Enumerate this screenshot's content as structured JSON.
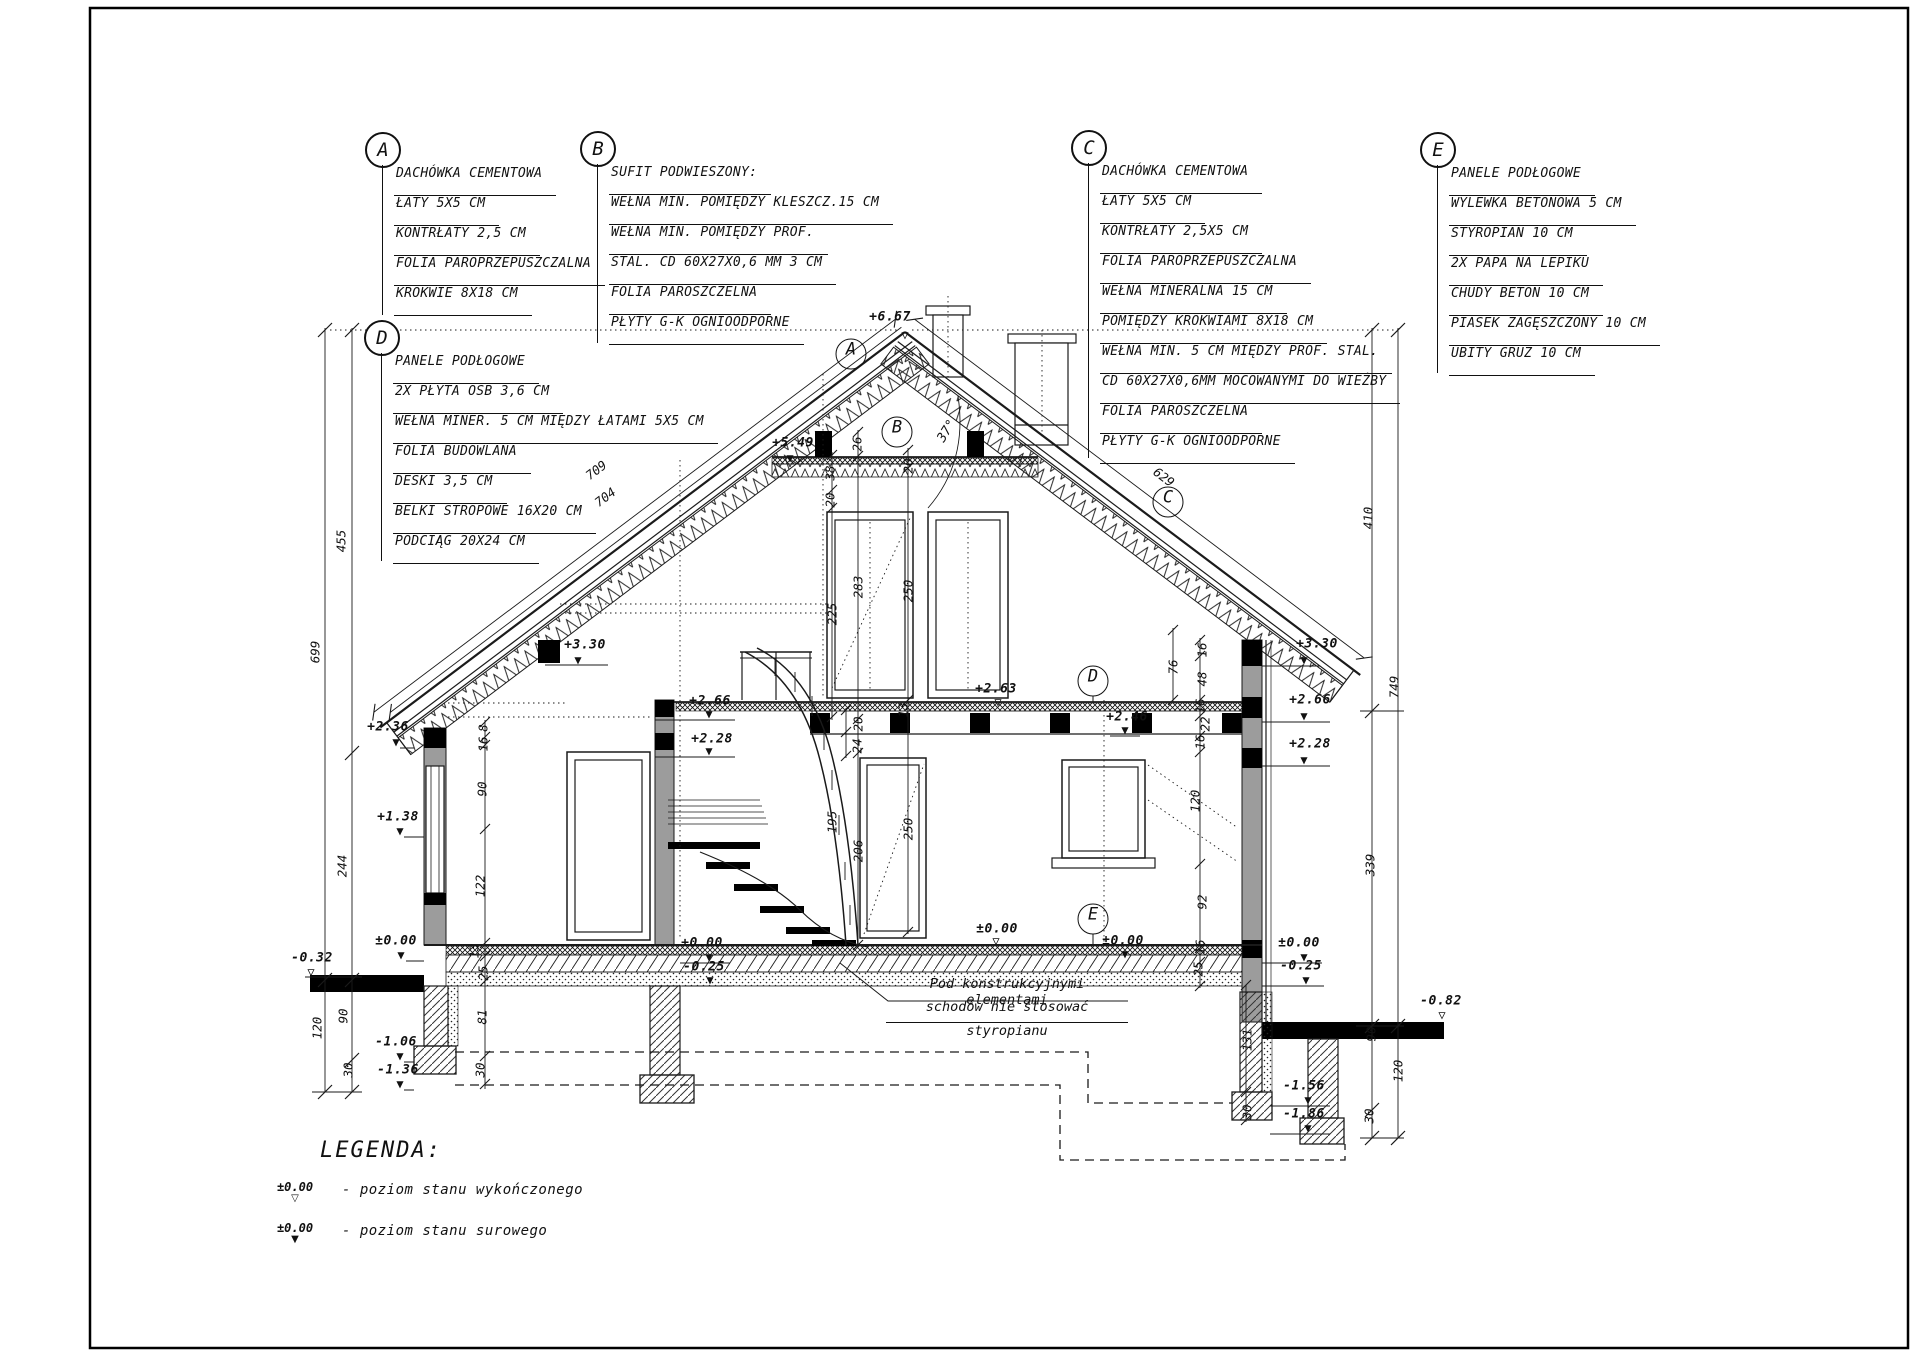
{
  "callouts": {
    "a": {
      "letter": "A",
      "items": [
        "DACHÓWKA CEMENTOWA",
        "ŁATY 5X5 CM",
        "KONTRŁATY 2,5 CM",
        "FOLIA PAROPRZEPUSZCZALNA",
        "KROKWIE 8X18 CM"
      ]
    },
    "b": {
      "letter": "B",
      "items": [
        "SUFIT PODWIESZONY:",
        "WEŁNA MIN. POMIĘDZY KLESZCZ.15 CM",
        "WEŁNA MIN. POMIĘDZY PROF.",
        "STAL. CD 60X27X0,6 MM 3 CM",
        "FOLIA PAROSZCZELNA",
        "PŁYTY G-K OGNIOODPORNE"
      ]
    },
    "c": {
      "letter": "C",
      "items": [
        "DACHÓWKA CEMENTOWA",
        "ŁATY 5X5 CM",
        "KONTRŁATY 2,5X5 CM",
        "FOLIA PAROPRZEPUSZCZALNA",
        "WEŁNA MINERALNA 15 CM",
        "POMIĘDZY KROKWIAMI 8X18 CM",
        "WEŁNA MIN. 5 CM MIĘDZY PROF. STAL.",
        "CD 60X27X0,6MM MOCOWANYMI DO WIEŻBY",
        "FOLIA PAROSZCZELNA",
        "PŁYTY G-K OGNIOODPORNE"
      ]
    },
    "d": {
      "letter": "D",
      "items": [
        "PANELE PODŁOGOWE",
        "2X PŁYTA OSB 3,6 CM",
        "WEŁNA MINER. 5 CM MIĘDZY ŁATAMI 5X5 CM",
        "FOLIA BUDOWLANA",
        "DESKI 3,5 CM",
        "BELKI STROPOWE 16X20 CM",
        "PODCIĄG 20X24 CM"
      ]
    },
    "e": {
      "letter": "E",
      "items": [
        "PANELE PODŁOGOWE",
        "WYLEWKA BETONOWA 5 CM",
        "STYROPIAN 10 CM",
        "2X PAPA NA LEPIKU",
        "CHUDY BETON 10 CM",
        "PIASEK ZAGĘSZCZONY 10 CM",
        "UBITY GRUZ 10 CM"
      ]
    }
  },
  "legend": {
    "title": "LEGENDA:",
    "items": [
      {
        "level": "±0.00",
        "symbol": "▽",
        "label": "- poziom stanu wykończonego"
      },
      {
        "level": "±0.00",
        "symbol": "▼",
        "label": "- poziom stanu surowego"
      }
    ]
  },
  "note": {
    "lines": [
      "Pod konstrukcyjnymi elementami",
      "schodów nie stosować",
      "styropianu"
    ]
  },
  "annotations": [
    {
      "t": "+6.67",
      "x": 890,
      "y": 317,
      "r": 0,
      "c": "elev"
    },
    {
      "t": "▽",
      "x": 905,
      "y": 335,
      "r": 0,
      "c": "symo"
    },
    {
      "t": "+5.49",
      "x": 793,
      "y": 443,
      "r": 0,
      "c": "elev"
    },
    {
      "t": "▼",
      "x": 790,
      "y": 458,
      "r": 0,
      "c": "symf"
    },
    {
      "t": "37°",
      "x": 947,
      "y": 431,
      "r": -58,
      "c": "deg"
    },
    {
      "t": "+3.30",
      "x": 585,
      "y": 645,
      "r": 0,
      "c": "elev"
    },
    {
      "t": "▼",
      "x": 578,
      "y": 660,
      "r": 0,
      "c": "symf"
    },
    {
      "t": "+3.30",
      "x": 1317,
      "y": 644,
      "r": 0,
      "c": "elev"
    },
    {
      "t": "▼",
      "x": 1304,
      "y": 660,
      "r": 0,
      "c": "symf"
    },
    {
      "t": "+2.36",
      "x": 388,
      "y": 727,
      "r": 0,
      "c": "elev"
    },
    {
      "t": "▼",
      "x": 396,
      "y": 742,
      "r": 0,
      "c": "symf"
    },
    {
      "t": "+2.66",
      "x": 710,
      "y": 701,
      "r": 0,
      "c": "elev"
    },
    {
      "t": "▼",
      "x": 709,
      "y": 714,
      "r": 0,
      "c": "symf"
    },
    {
      "t": "+2.28",
      "x": 712,
      "y": 739,
      "r": 0,
      "c": "elev"
    },
    {
      "t": "▼",
      "x": 709,
      "y": 751,
      "r": 0,
      "c": "symf"
    },
    {
      "t": "+2.63",
      "x": 996,
      "y": 689,
      "r": 0,
      "c": "elev"
    },
    {
      "t": "▽",
      "x": 998,
      "y": 702,
      "r": 0,
      "c": "symo"
    },
    {
      "t": "+2.46",
      "x": 1127,
      "y": 717,
      "r": 0,
      "c": "elev"
    },
    {
      "t": "▼",
      "x": 1125,
      "y": 730,
      "r": 0,
      "c": "symf"
    },
    {
      "t": "+2.66",
      "x": 1310,
      "y": 700,
      "r": 0,
      "c": "elev"
    },
    {
      "t": "▼",
      "x": 1304,
      "y": 716,
      "r": 0,
      "c": "symf"
    },
    {
      "t": "+2.28",
      "x": 1310,
      "y": 744,
      "r": 0,
      "c": "elev"
    },
    {
      "t": "▼",
      "x": 1304,
      "y": 760,
      "r": 0,
      "c": "symf"
    },
    {
      "t": "+1.38",
      "x": 398,
      "y": 817,
      "r": 0,
      "c": "elev"
    },
    {
      "t": "▼",
      "x": 400,
      "y": 831,
      "r": 0,
      "c": "symf"
    },
    {
      "t": "±0.00",
      "x": 396,
      "y": 941,
      "r": 0,
      "c": "elev"
    },
    {
      "t": "▼",
      "x": 401,
      "y": 955,
      "r": 0,
      "c": "symf"
    },
    {
      "t": "-0.32",
      "x": 312,
      "y": 958,
      "r": 0,
      "c": "elev"
    },
    {
      "t": "▽",
      "x": 311,
      "y": 972,
      "r": 0,
      "c": "symo"
    },
    {
      "t": "+0.00",
      "x": 702,
      "y": 943,
      "r": 0,
      "c": "elev"
    },
    {
      "t": "▼",
      "x": 709,
      "y": 957,
      "r": 0,
      "c": "symf"
    },
    {
      "t": "-0.25",
      "x": 704,
      "y": 967,
      "r": 0,
      "c": "elev"
    },
    {
      "t": "▼",
      "x": 710,
      "y": 980,
      "r": 0,
      "c": "symf"
    },
    {
      "t": "±0.00",
      "x": 997,
      "y": 929,
      "r": 0,
      "c": "elev"
    },
    {
      "t": "▽",
      "x": 996,
      "y": 941,
      "r": 0,
      "c": "symo"
    },
    {
      "t": "±0.00",
      "x": 1123,
      "y": 941,
      "r": 0,
      "c": "elev"
    },
    {
      "t": "▼",
      "x": 1125,
      "y": 954,
      "r": 0,
      "c": "symf"
    },
    {
      "t": "±0.00",
      "x": 1299,
      "y": 943,
      "r": 0,
      "c": "elev"
    },
    {
      "t": "▼",
      "x": 1304,
      "y": 957,
      "r": 0,
      "c": "symf"
    },
    {
      "t": "-0.25",
      "x": 1301,
      "y": 966,
      "r": 0,
      "c": "elev"
    },
    {
      "t": "▼",
      "x": 1306,
      "y": 980,
      "r": 0,
      "c": "symf"
    },
    {
      "t": "-0.82",
      "x": 1441,
      "y": 1001,
      "r": 0,
      "c": "elev"
    },
    {
      "t": "▽",
      "x": 1442,
      "y": 1015,
      "r": 0,
      "c": "symo"
    },
    {
      "t": "-1.06",
      "x": 396,
      "y": 1042,
      "r": 0,
      "c": "elev"
    },
    {
      "t": "▼",
      "x": 400,
      "y": 1056,
      "r": 0,
      "c": "symf"
    },
    {
      "t": "-1.36",
      "x": 398,
      "y": 1070,
      "r": 0,
      "c": "elev"
    },
    {
      "t": "▼",
      "x": 400,
      "y": 1084,
      "r": 0,
      "c": "symf"
    },
    {
      "t": "-1.56",
      "x": 1304,
      "y": 1086,
      "r": 0,
      "c": "elev"
    },
    {
      "t": "▼",
      "x": 1308,
      "y": 1100,
      "r": 0,
      "c": "symf"
    },
    {
      "t": "-1.86",
      "x": 1304,
      "y": 1114,
      "r": 0,
      "c": "elev"
    },
    {
      "t": "▼",
      "x": 1308,
      "y": 1128,
      "r": 0,
      "c": "symf"
    },
    {
      "t": "699",
      "x": 315,
      "y": 652,
      "r": -90,
      "c": "dim"
    },
    {
      "t": "455",
      "x": 341,
      "y": 541,
      "r": -90,
      "c": "dim"
    },
    {
      "t": "244",
      "x": 342,
      "y": 866,
      "r": -90,
      "c": "dim"
    },
    {
      "t": "120",
      "x": 317,
      "y": 1028,
      "r": -90,
      "c": "dim"
    },
    {
      "t": "90",
      "x": 343,
      "y": 1016,
      "r": -90,
      "c": "dim"
    },
    {
      "t": "30",
      "x": 348,
      "y": 1070,
      "r": -90,
      "c": "dim"
    },
    {
      "t": "410",
      "x": 1368,
      "y": 518,
      "r": -90,
      "c": "dim"
    },
    {
      "t": "749",
      "x": 1394,
      "y": 687,
      "r": -90,
      "c": "dim"
    },
    {
      "t": "339",
      "x": 1370,
      "y": 865,
      "r": -90,
      "c": "dim"
    },
    {
      "t": "90",
      "x": 1371,
      "y": 1034,
      "r": -90,
      "c": "dim"
    },
    {
      "t": "120",
      "x": 1398,
      "y": 1071,
      "r": -90,
      "c": "dim"
    },
    {
      "t": "30",
      "x": 1369,
      "y": 1116,
      "r": -90,
      "c": "dim"
    },
    {
      "t": "8",
      "x": 483,
      "y": 728,
      "r": -90,
      "c": "dim"
    },
    {
      "t": "16",
      "x": 483,
      "y": 744,
      "r": -90,
      "c": "dim"
    },
    {
      "t": "90",
      "x": 482,
      "y": 789,
      "r": -90,
      "c": "dim"
    },
    {
      "t": "122",
      "x": 480,
      "y": 886,
      "r": -90,
      "c": "dim"
    },
    {
      "t": "13",
      "x": 474,
      "y": 951,
      "r": -90,
      "c": "dim"
    },
    {
      "t": "25",
      "x": 483,
      "y": 973,
      "r": -90,
      "c": "dim"
    },
    {
      "t": "81",
      "x": 482,
      "y": 1017,
      "r": -90,
      "c": "dim"
    },
    {
      "t": "30",
      "x": 480,
      "y": 1070,
      "r": -90,
      "c": "dim"
    },
    {
      "t": "26",
      "x": 857,
      "y": 444,
      "r": -90,
      "c": "dim"
    },
    {
      "t": "38",
      "x": 830,
      "y": 473,
      "r": -90,
      "c": "dim"
    },
    {
      "t": "20",
      "x": 830,
      "y": 500,
      "r": -90,
      "c": "dim"
    },
    {
      "t": "20",
      "x": 908,
      "y": 466,
      "r": -90,
      "c": "dim"
    },
    {
      "t": "283",
      "x": 858,
      "y": 587,
      "r": -90,
      "c": "dim"
    },
    {
      "t": "250",
      "x": 908,
      "y": 591,
      "r": -90,
      "c": "dim"
    },
    {
      "t": "225",
      "x": 832,
      "y": 614,
      "r": -90,
      "c": "dim"
    },
    {
      "t": "13",
      "x": 903,
      "y": 710,
      "r": -90,
      "c": "dim"
    },
    {
      "t": "20",
      "x": 858,
      "y": 724,
      "r": -90,
      "c": "dim"
    },
    {
      "t": "24",
      "x": 857,
      "y": 746,
      "r": -90,
      "c": "dim"
    },
    {
      "t": "195",
      "x": 832,
      "y": 822,
      "r": -90,
      "c": "dim"
    },
    {
      "t": "206",
      "x": 858,
      "y": 851,
      "r": -90,
      "c": "dim"
    },
    {
      "t": "250",
      "x": 908,
      "y": 829,
      "r": -90,
      "c": "dim"
    },
    {
      "t": "76",
      "x": 1173,
      "y": 667,
      "r": -90,
      "c": "dim"
    },
    {
      "t": "16",
      "x": 1202,
      "y": 650,
      "r": -90,
      "c": "dim"
    },
    {
      "t": "48",
      "x": 1202,
      "y": 679,
      "r": -90,
      "c": "dim"
    },
    {
      "t": "16",
      "x": 1200,
      "y": 706,
      "r": -90,
      "c": "dim"
    },
    {
      "t": "22",
      "x": 1205,
      "y": 724,
      "r": -90,
      "c": "dim"
    },
    {
      "t": "16",
      "x": 1200,
      "y": 742,
      "r": -90,
      "c": "dim"
    },
    {
      "t": "120",
      "x": 1195,
      "y": 801,
      "r": -90,
      "c": "dim"
    },
    {
      "t": "92",
      "x": 1202,
      "y": 902,
      "r": -90,
      "c": "dim"
    },
    {
      "t": "16",
      "x": 1200,
      "y": 947,
      "r": -90,
      "c": "dim"
    },
    {
      "t": "25",
      "x": 1198,
      "y": 969,
      "r": -90,
      "c": "dim"
    },
    {
      "t": "131",
      "x": 1247,
      "y": 1040,
      "r": -90,
      "c": "dim"
    },
    {
      "t": "30",
      "x": 1247,
      "y": 1112,
      "r": -90,
      "c": "dim"
    },
    {
      "t": "709",
      "x": 596,
      "y": 470,
      "r": -37,
      "c": "dim"
    },
    {
      "t": "704",
      "x": 605,
      "y": 497,
      "r": -37,
      "c": "dim"
    },
    {
      "t": "629",
      "x": 1164,
      "y": 477,
      "r": 37,
      "c": "dim"
    },
    {
      "t": "A",
      "x": 851,
      "y": 354,
      "r": 0,
      "c": "circ"
    },
    {
      "t": "B",
      "x": 897,
      "y": 432,
      "r": 0,
      "c": "circ"
    },
    {
      "t": "C",
      "x": 1168,
      "y": 502,
      "r": 0,
      "c": "circ"
    },
    {
      "t": "D",
      "x": 1093,
      "y": 681,
      "r": 0,
      "c": "circ"
    },
    {
      "t": "E",
      "x": 1093,
      "y": 919,
      "r": 0,
      "c": "circ"
    }
  ]
}
